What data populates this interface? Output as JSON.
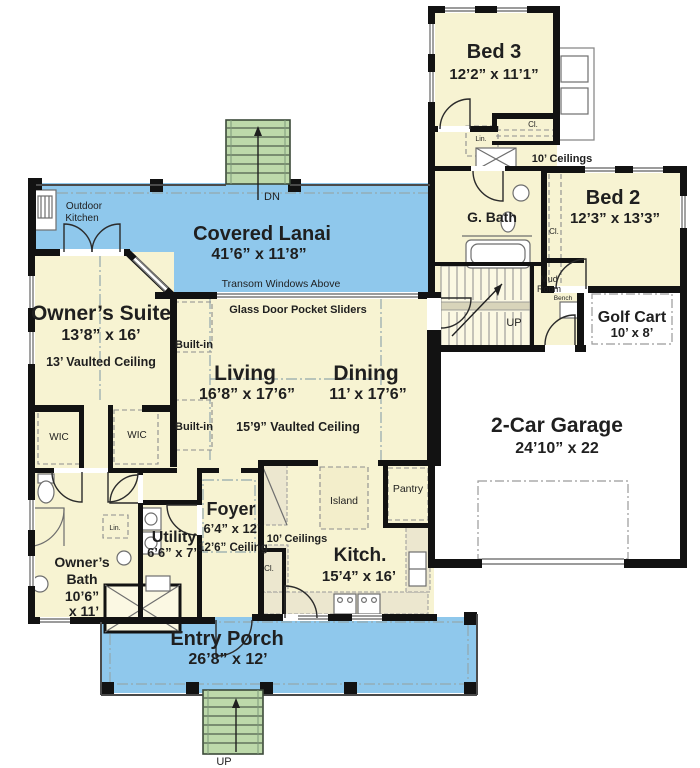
{
  "plan": {
    "rooms": {
      "bed3": {
        "name": "Bed 3",
        "dims": "12’2” x 11’1”"
      },
      "bed2": {
        "name": "Bed 2",
        "dims": "12’3” x 13’3”"
      },
      "guest_bath": {
        "name": "G. Bath"
      },
      "golf_cart": {
        "name": "Golf Cart",
        "dims": "10’ x 8’"
      },
      "garage": {
        "name": "2-Car Garage",
        "dims": "24’10” x 22"
      },
      "covered_lanai": {
        "name": "Covered Lanai",
        "dims": "41’6” x 11’8”"
      },
      "owners_suite": {
        "name": "Owner’s Suite",
        "dims": "13’8” x 16’",
        "ceiling": "13’ Vaulted Ceiling"
      },
      "living": {
        "name": "Living",
        "dims": "16’8” x 17’6”"
      },
      "dining": {
        "name": "Dining",
        "dims": "11’ x 17’6”"
      },
      "foyer": {
        "name": "Foyer",
        "dims": "6’4” x 12’",
        "ceiling": "12’6” Ceiling"
      },
      "utility": {
        "name": "Utility",
        "dims": "6’6” x 7’"
      },
      "owners_bath": {
        "name_line1": "Owner’s",
        "name_line2": "Bath",
        "dims_line1": "10’6”",
        "dims_line2": "x 11’"
      },
      "kitchen": {
        "name": "Kitch.",
        "dims": "15’4” x 16’"
      },
      "entry_porch": {
        "name": "Entry Porch",
        "dims": "26’8” x 12’"
      },
      "mud_room": {
        "name_line1": "Mud",
        "name_line2": "Room"
      }
    },
    "annotations": {
      "outdoor_kitchen_line1": "Outdoor",
      "outdoor_kitchen_line2": "Kitchen",
      "transom": "Transom Windows Above",
      "glass_sliders": "Glass Door Pocket Sliders",
      "vaulted_ceiling_159": "15’9” Vaulted Ceiling",
      "built_in": "Built-in",
      "ceilings_10": "10’ Ceilings",
      "wic": "WIC",
      "linen": "Lin.",
      "closet": "Cl.",
      "pantry": "Pantry",
      "island": "Island",
      "bench": "Bench",
      "up": "UP",
      "dn": "DN"
    },
    "colors": {
      "room_fill": "#f7f3d2",
      "porch_fill": "#8fc8ec",
      "stair_fill": "#bdd9aa",
      "wall": "#121212"
    }
  }
}
